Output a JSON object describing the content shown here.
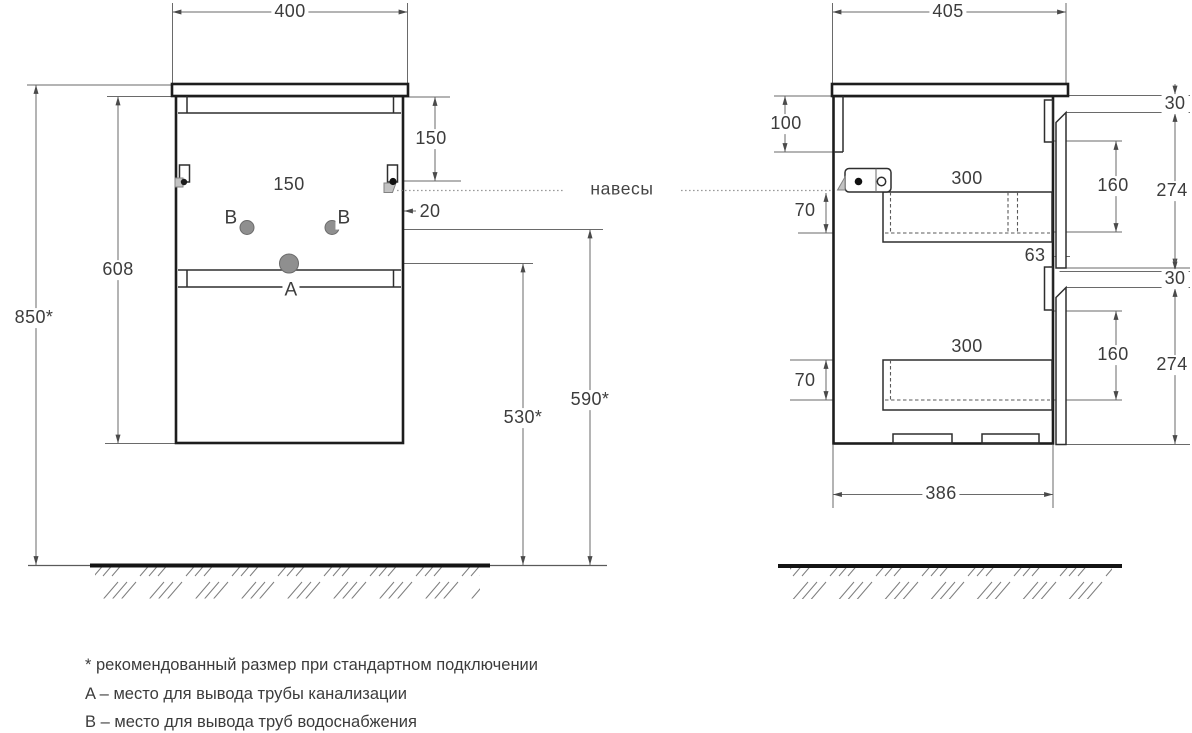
{
  "drawing_type": "furniture installation diagram",
  "front_view": {
    "dim_width_top": "400",
    "dim_top_offset": "150",
    "dim_hole_spacing": "150",
    "dim_hanger_offset": "20",
    "dim_cabinet_height": "608",
    "dim_total_height": "850*",
    "dim_drain_height": "530*",
    "dim_supply_height": "590*",
    "label_a": "A",
    "label_b_left": "B",
    "label_b_right": "B"
  },
  "side_view": {
    "dim_depth_top": "405",
    "dim_back_inset": "100",
    "dim_hanger_drop_upper": "70",
    "dim_hanger_drop_lower": "70",
    "dim_drawer_depth_upper": "300",
    "dim_drawer_depth_lower": "300",
    "dim_rail_clearance": "63",
    "dim_gap_top": "30",
    "dim_gap_middle": "30",
    "dim_front_recess_upper": "160",
    "dim_front_recess_lower": "160",
    "dim_front_height_upper": "274",
    "dim_front_height_lower": "274",
    "dim_bottom_depth": "386"
  },
  "annotations": {
    "hangers_label": "навесы"
  },
  "footnotes": [
    "* рекомендованный размер при стандартном подключении",
    "A – место для вывода трубы канализации",
    "B – место для вывода труб водоснабжения"
  ],
  "colors": {
    "line": "#1d1d1d",
    "dim_line": "#5a5a5a",
    "text": "#3c3c3c",
    "hole_fill": "#8f8f8f",
    "background": "#ffffff"
  }
}
